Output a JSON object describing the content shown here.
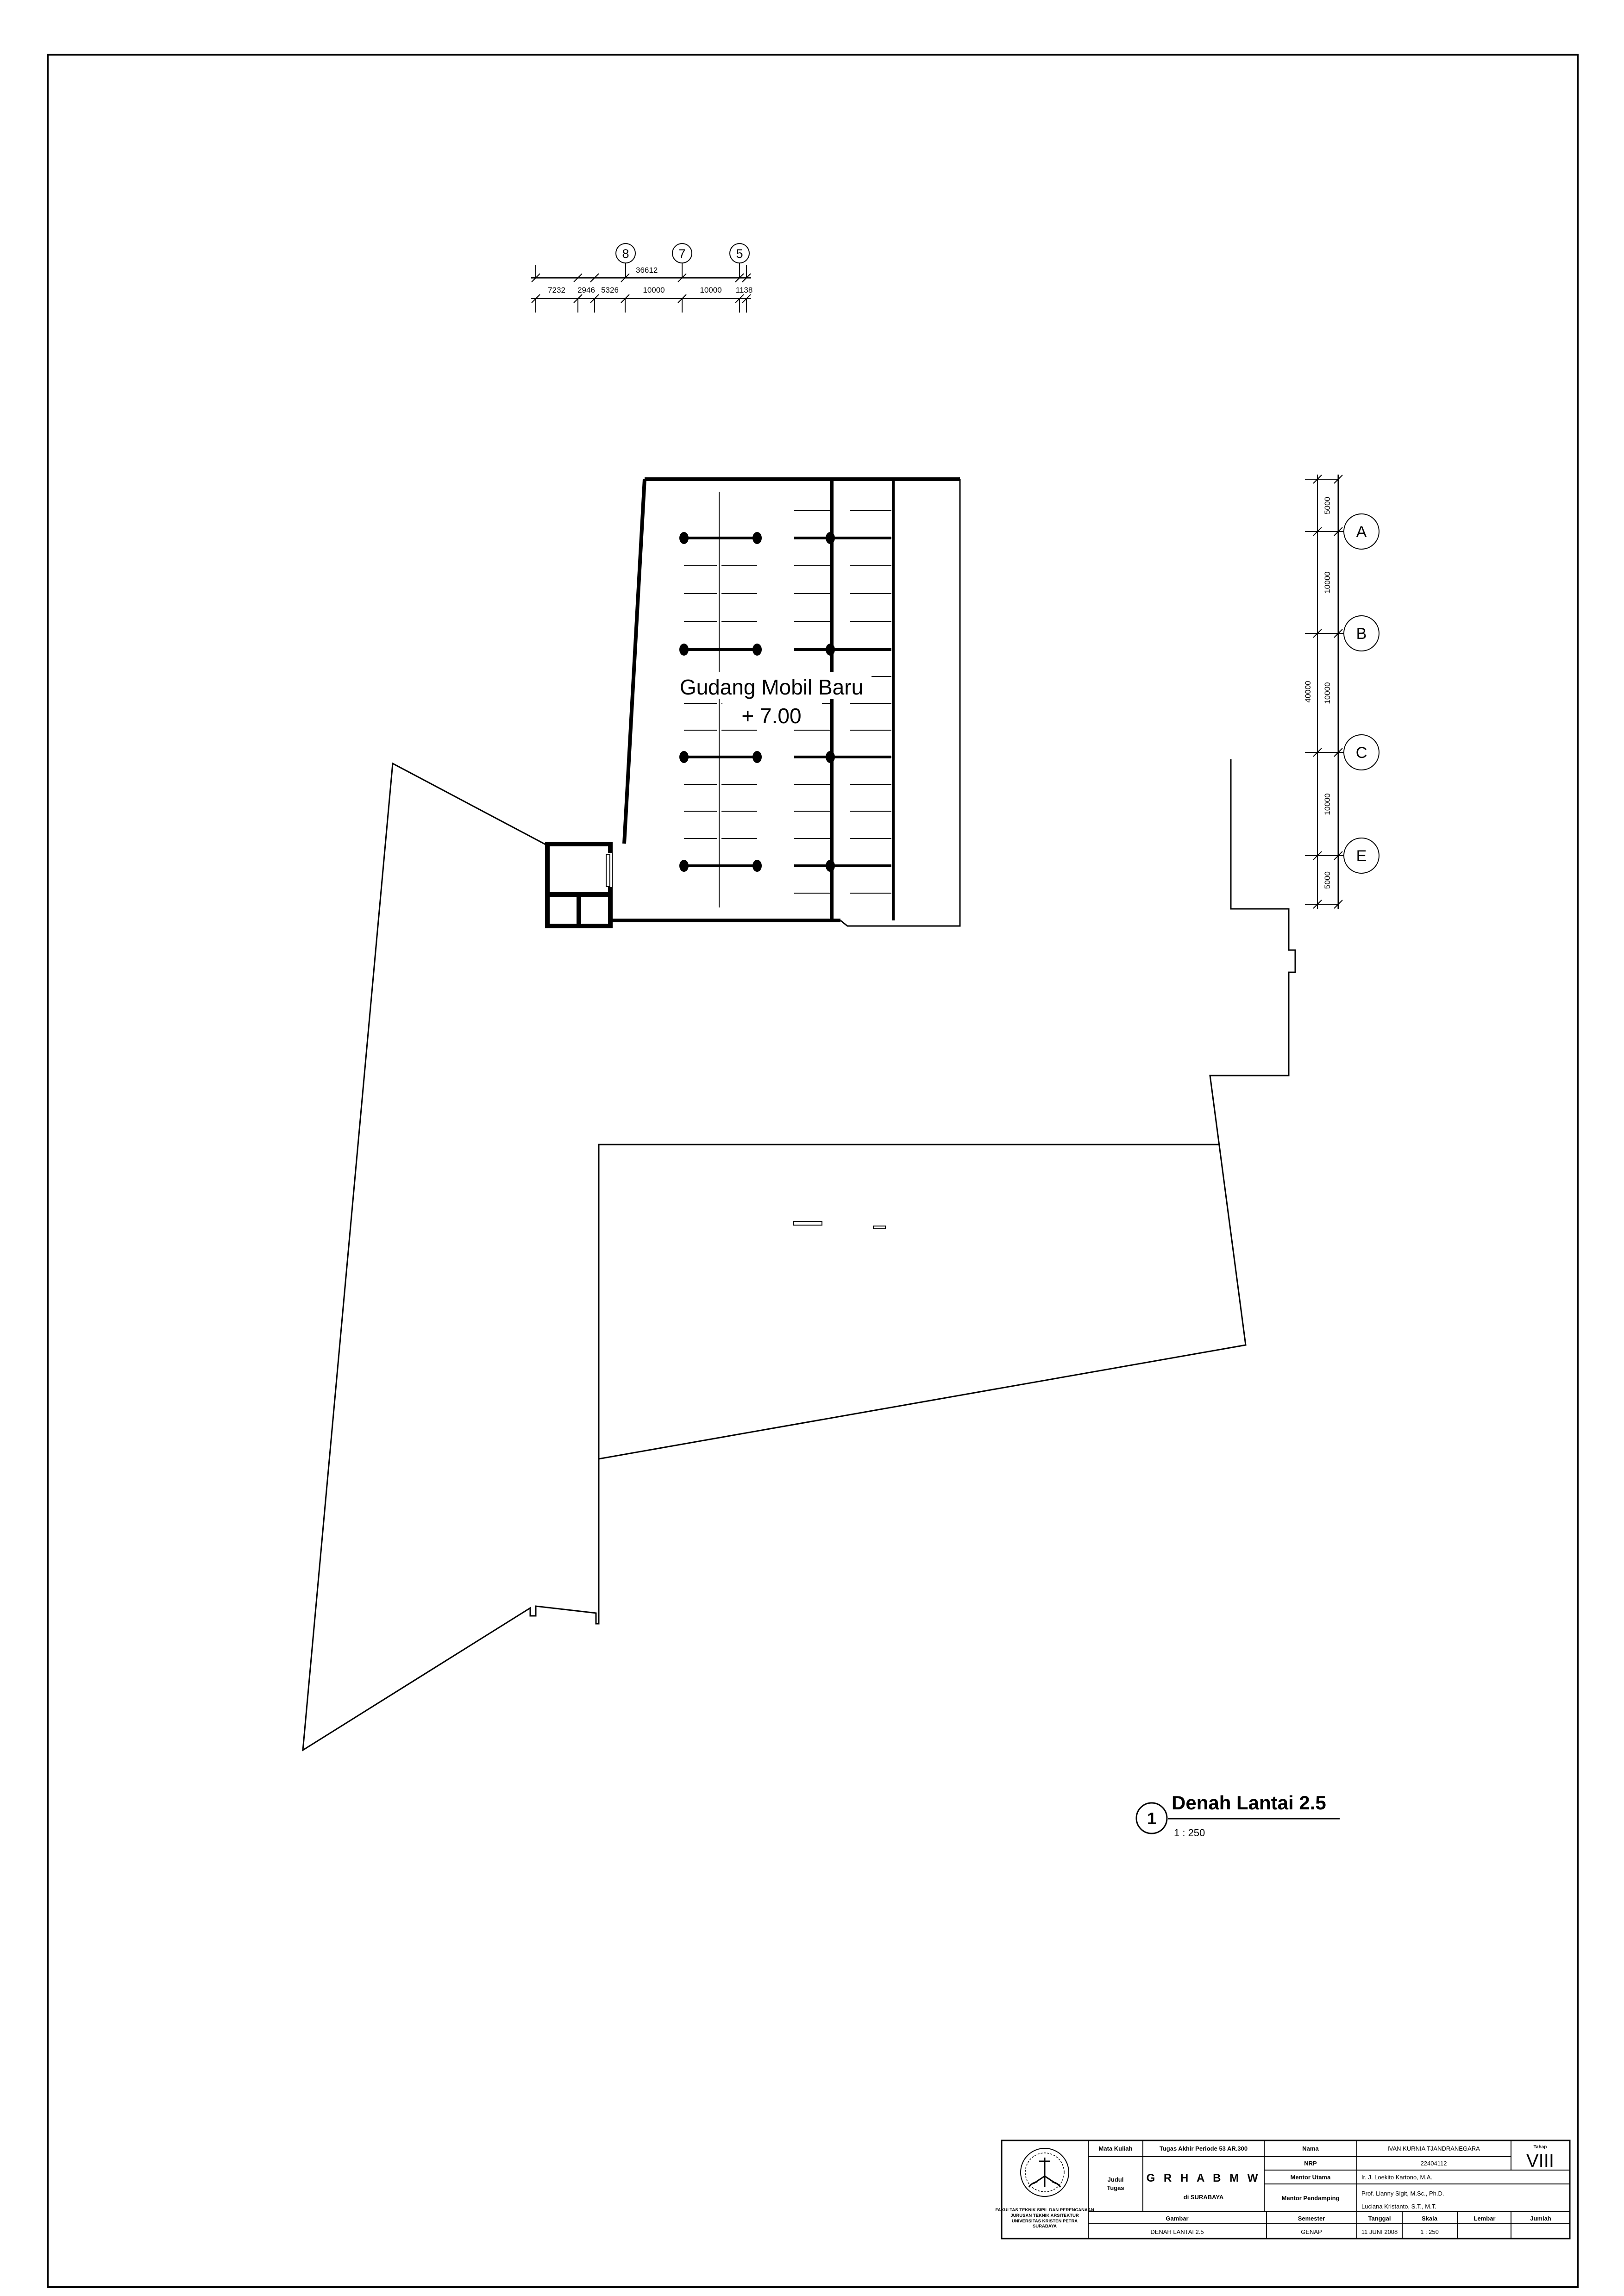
{
  "drawing": {
    "room_label": {
      "line1": "Gudang Mobil Baru",
      "line2": "+ 7.00"
    },
    "view_title": {
      "number": "1",
      "text": "Denah Lantai 2.5",
      "scale": "1 : 250"
    },
    "grid_top": {
      "b8": "8",
      "b7": "7",
      "b5": "5"
    },
    "grid_right": {
      "bA": "A",
      "bB": "B",
      "bC": "C",
      "bE": "E"
    },
    "dim_top": {
      "total": "36612",
      "s1": "7232",
      "s2": "2946",
      "s3": "5326",
      "s4": "10000",
      "s5": "10000",
      "s6": "1138"
    },
    "dim_right": {
      "total": "40000",
      "s1": "5000",
      "s2": "10000",
      "s3": "10000",
      "s4": "10000",
      "s5": "5000"
    }
  },
  "title_block": {
    "institution": {
      "l1": "FAKULTAS TEKNIK SIPIL DAN PERENCANAAN",
      "l2": "JURUSAN TEKNIK ARSITEKTUR",
      "l3": "UNIVERSITAS KRISTEN PETRA",
      "l4": "SURABAYA"
    },
    "mata_kuliah": {
      "label": "Mata Kuliah",
      "value": "Tugas Akhir Periode 53 AR.300"
    },
    "judul_tugas": {
      "label1": "Judul",
      "label2": "Tugas",
      "value1": "G R H A  B M W",
      "value2": "di SURABAYA"
    },
    "nama": {
      "label": "Nama",
      "value": "IVAN KURNIA TJANDRANEGARA"
    },
    "nrp": {
      "label": "NRP",
      "value": "22404112"
    },
    "mentor_utama": {
      "label": "Mentor Utama",
      "value": "Ir. J. Loekito Kartono, M.A."
    },
    "mentor_pendamping": {
      "label": "Mentor Pendamping",
      "value1": "Prof. Lianny Sigit, M.Sc., Ph.D.",
      "value2": "Luciana Kristanto, S.T., M.T."
    },
    "tahap": {
      "label": "Tahap",
      "value": "VIII"
    },
    "gambar": {
      "label": "Gambar",
      "value": "DENAH LANTAI 2.5"
    },
    "semester": {
      "label": "Semester",
      "value": "GENAP"
    },
    "tanggal": {
      "label": "Tanggal",
      "value": "11 JUNI 2008"
    },
    "skala": {
      "label": "Skala",
      "value": "1 : 250"
    },
    "lembar": {
      "label": "Lembar",
      "value": ""
    },
    "jumlah": {
      "label": "Jumlah",
      "value": ""
    }
  }
}
